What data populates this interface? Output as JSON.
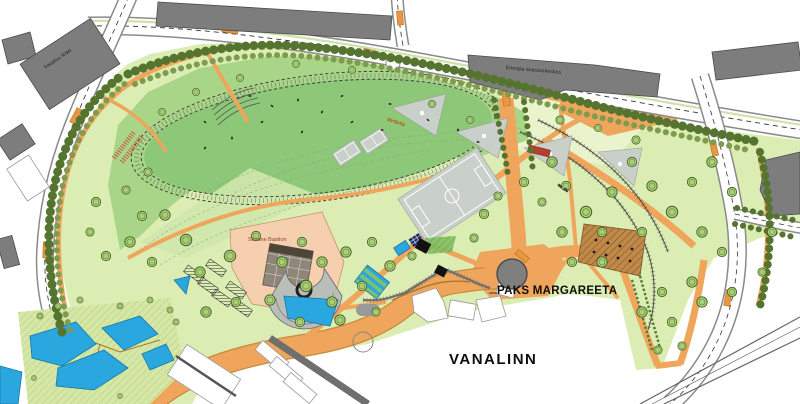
{
  "map": {
    "labels": {
      "rimi": "kauplus RIMI",
      "energia": "Energia avastuskeskus",
      "skoone_bastion": "Skoone Bastion",
      "paks_margareeta": "PAKS MARGAREETA",
      "vanalinn": "VANALINN"
    },
    "colors": {
      "park_light": "#dcedb4",
      "park_pale": "#e9f3cc",
      "field_mid": "#a9d589",
      "field_dark": "#8cc878",
      "gradient_band": "#cfe7ab",
      "tree_dark": "#55742f",
      "tree_mid": "#7e9c4e",
      "tree_fill": "#abd075",
      "tree_stroke": "#3f5e26",
      "path_orange": "#efa55c",
      "path_dark": "#c9893b",
      "crossing": "#e8963f",
      "water": "#2aa7df",
      "water_dark": "#1577a8",
      "building": "#7d7d7d",
      "building_dark": "#4a4a4a",
      "sport": "#c9cfc9",
      "salmon": "#f6cfae",
      "brown_square": "#c08948",
      "road_casing": "#8a8a8a",
      "wall_gray": "#6f6f6f"
    }
  }
}
